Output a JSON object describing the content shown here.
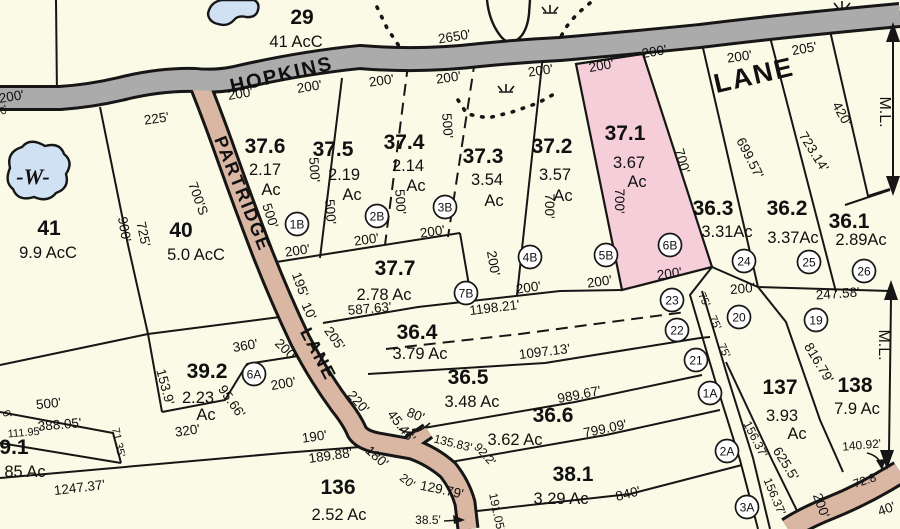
{
  "map": {
    "colors": {
      "parcel_fill": "#FAFAE6",
      "line": "#161616",
      "highlight_parcel": "#F6CEDA",
      "road_paved": "#ABABAB",
      "road_partridge": "#D9B7A3",
      "water": "#CFE1F2"
    },
    "roads": [
      {
        "name": "HOPKINS",
        "x": 283,
        "y": 81,
        "rot": -13,
        "fs": 20,
        "ls": 3
      },
      {
        "name": "LANE",
        "x": 756,
        "y": 84,
        "rot": -13,
        "fs": 27,
        "ls": 8
      },
      {
        "name": "PARTRIDGE",
        "x": 237,
        "y": 196,
        "rot": 68,
        "fs": 18,
        "ls": 2
      },
      {
        "name": "LANE",
        "x": 313,
        "y": 357,
        "rot": 62,
        "fs": 18,
        "ls": 2
      }
    ],
    "water_label": {
      "t": "-W-",
      "x": 33,
      "y": 184,
      "fs": 22
    },
    "match_line_labels": [
      {
        "t": "M.L.",
        "x": 880,
        "y": 112,
        "rot": 90,
        "fs": 16
      },
      {
        "t": "M.L.",
        "x": 879,
        "y": 345,
        "rot": 90,
        "fs": 16
      }
    ],
    "parcels": [
      {
        "id": "29",
        "number": "29",
        "nx": 302,
        "ny": 24,
        "acres": [
          {
            "t": "41  AcC",
            "x": 296,
            "y": 47
          }
        ],
        "highlighted": false
      },
      {
        "id": "41",
        "number": "41",
        "nx": 49,
        "ny": 235,
        "acres": [
          {
            "t": "9.9  AcC",
            "x": 48,
            "y": 258
          }
        ],
        "highlighted": false
      },
      {
        "id": "40",
        "number": "40",
        "nx": 181,
        "ny": 237,
        "acres": [
          {
            "t": "5.0  AcC",
            "x": 196,
            "y": 260
          }
        ],
        "highlighted": false
      },
      {
        "id": "37.6",
        "number": "37.6",
        "nx": 265,
        "ny": 153,
        "acres": [
          {
            "t": "2.17",
            "x": 265,
            "y": 175
          },
          {
            "t": "Ac",
            "x": 271,
            "y": 195
          }
        ],
        "highlighted": false
      },
      {
        "id": "37.5",
        "number": "37.5",
        "nx": 333,
        "ny": 156,
        "acres": [
          {
            "t": "2.19",
            "x": 344,
            "y": 180
          },
          {
            "t": "Ac",
            "x": 352,
            "y": 200
          }
        ],
        "highlighted": false
      },
      {
        "id": "37.4",
        "number": "37.4",
        "nx": 404,
        "ny": 149,
        "acres": [
          {
            "t": "2.14",
            "x": 408,
            "y": 171
          },
          {
            "t": "Ac",
            "x": 416,
            "y": 191
          }
        ],
        "highlighted": false
      },
      {
        "id": "37.3",
        "number": "37.3",
        "nx": 483,
        "ny": 163,
        "acres": [
          {
            "t": "3.54",
            "x": 487,
            "y": 185
          },
          {
            "t": "Ac",
            "x": 494,
            "y": 206
          }
        ],
        "highlighted": false
      },
      {
        "id": "37.2",
        "number": "37.2",
        "nx": 552,
        "ny": 153,
        "acres": [
          {
            "t": "3.57",
            "x": 555,
            "y": 180
          },
          {
            "t": "Ac",
            "x": 563,
            "y": 201
          }
        ],
        "highlighted": false
      },
      {
        "id": "37.1",
        "number": "37.1",
        "nx": 625,
        "ny": 140,
        "acres": [
          {
            "t": "3.67",
            "x": 629,
            "y": 168
          },
          {
            "t": "Ac",
            "x": 637,
            "y": 187
          }
        ],
        "highlighted": true
      },
      {
        "id": "37.7",
        "number": "37.7",
        "nx": 395,
        "ny": 275,
        "acres": [
          {
            "t": "2.78  Ac",
            "x": 384,
            "y": 300
          }
        ],
        "highlighted": false
      },
      {
        "id": "36.3",
        "number": "36.3",
        "nx": 713,
        "ny": 215,
        "acres": [
          {
            "t": "3.31Ac",
            "x": 727,
            "y": 237
          }
        ],
        "highlighted": false
      },
      {
        "id": "36.2",
        "number": "36.2",
        "nx": 787,
        "ny": 215,
        "acres": [
          {
            "t": "3.37Ac",
            "x": 793,
            "y": 243
          }
        ],
        "highlighted": false
      },
      {
        "id": "36.1",
        "number": "36.1",
        "nx": 849,
        "ny": 228,
        "acres": [
          {
            "t": "2.89Ac",
            "x": 861,
            "y": 245
          }
        ],
        "highlighted": false
      },
      {
        "id": "36.4",
        "number": "36.4",
        "nx": 417,
        "ny": 339,
        "acres": [
          {
            "t": "3.79  Ac",
            "x": 420,
            "y": 359
          }
        ],
        "highlighted": false
      },
      {
        "id": "36.5",
        "number": "36.5",
        "nx": 468,
        "ny": 384,
        "acres": [
          {
            "t": "3.48  Ac",
            "x": 472,
            "y": 407
          }
        ],
        "highlighted": false
      },
      {
        "id": "36.6",
        "number": "36.6",
        "nx": 553,
        "ny": 422,
        "acres": [
          {
            "t": "3.62  Ac",
            "x": 515,
            "y": 445
          }
        ],
        "highlighted": false
      },
      {
        "id": "38.1",
        "number": "38.1",
        "nx": 573,
        "ny": 481,
        "acres": [
          {
            "t": "3.29  Ac",
            "x": 561,
            "y": 504
          }
        ],
        "highlighted": false
      },
      {
        "id": "136",
        "number": "136",
        "nx": 338,
        "ny": 494,
        "acres": [
          {
            "t": "2.52  Ac",
            "x": 339,
            "y": 520
          }
        ],
        "highlighted": false
      },
      {
        "id": "137",
        "number": "137",
        "nx": 780,
        "ny": 394,
        "acres": [
          {
            "t": "3.93",
            "x": 782,
            "y": 421
          },
          {
            "t": "Ac",
            "x": 797,
            "y": 439
          }
        ],
        "highlighted": false
      },
      {
        "id": "138",
        "number": "138",
        "nx": 855,
        "ny": 392,
        "acres": [
          {
            "t": "7.9  Ac",
            "x": 857,
            "y": 414
          }
        ],
        "highlighted": false
      },
      {
        "id": "39.2",
        "number": "39.2",
        "nx": 207,
        "ny": 378,
        "acres": [
          {
            "t": "2.23",
            "x": 198,
            "y": 403
          },
          {
            "t": "Ac",
            "x": 206,
            "y": 420
          }
        ],
        "highlighted": false
      },
      {
        "id": "39.1",
        "number": "9.1",
        "nx": 14,
        "ny": 454,
        "acres": [
          {
            "t": "85  Ac",
            "x": 25,
            "y": 477
          }
        ],
        "highlighted": false
      }
    ],
    "badges": [
      {
        "t": "1B",
        "x": 297,
        "y": 224
      },
      {
        "t": "2B",
        "x": 377,
        "y": 216
      },
      {
        "t": "3B",
        "x": 445,
        "y": 207
      },
      {
        "t": "4B",
        "x": 530,
        "y": 257
      },
      {
        "t": "5B",
        "x": 606,
        "y": 255
      },
      {
        "t": "6B",
        "x": 670,
        "y": 245
      },
      {
        "t": "7B",
        "x": 466,
        "y": 293
      },
      {
        "t": "6A",
        "x": 254,
        "y": 374
      },
      {
        "t": "1A",
        "x": 710,
        "y": 393
      },
      {
        "t": "2A",
        "x": 727,
        "y": 451
      },
      {
        "t": "3A",
        "x": 747,
        "y": 507
      },
      {
        "t": "19",
        "x": 816,
        "y": 320
      },
      {
        "t": "20",
        "x": 739,
        "y": 317
      },
      {
        "t": "21",
        "x": 696,
        "y": 360
      },
      {
        "t": "22",
        "x": 677,
        "y": 330
      },
      {
        "t": "23",
        "x": 672,
        "y": 300
      },
      {
        "t": "24",
        "x": 744,
        "y": 261
      },
      {
        "t": "25",
        "x": 809,
        "y": 262
      },
      {
        "t": "26",
        "x": 864,
        "y": 271
      }
    ],
    "dimensions": [
      {
        "t": "2650'",
        "x": 455,
        "y": 41,
        "r": -9
      },
      {
        "t": "200'",
        "x": 12,
        "y": 101,
        "r": -9
      },
      {
        "t": "200'",
        "x": 241,
        "y": 98,
        "r": -9
      },
      {
        "t": "200'",
        "x": 310,
        "y": 91,
        "r": -9
      },
      {
        "t": "200'",
        "x": 382,
        "y": 85,
        "r": -8
      },
      {
        "t": "200'",
        "x": 449,
        "y": 82,
        "r": -8
      },
      {
        "t": "200'",
        "x": 541,
        "y": 75,
        "r": -8
      },
      {
        "t": "200'",
        "x": 602,
        "y": 70,
        "r": -10
      },
      {
        "t": "200'",
        "x": 655,
        "y": 56,
        "r": -10
      },
      {
        "t": "200'",
        "x": 740,
        "y": 61,
        "r": -8
      },
      {
        "t": "205'",
        "x": 805,
        "y": 53,
        "r": -10
      },
      {
        "t": "225'",
        "x": 157,
        "y": 123,
        "r": -8
      },
      {
        "t": "500'",
        "x": 266,
        "y": 217,
        "r": 72
      },
      {
        "t": "500'",
        "x": 310,
        "y": 170,
        "r": 86
      },
      {
        "t": "500'",
        "x": 326,
        "y": 212,
        "r": 86
      },
      {
        "t": "500'",
        "x": 396,
        "y": 202,
        "r": 86
      },
      {
        "t": "500'",
        "x": 443,
        "y": 126,
        "r": 86
      },
      {
        "t": "700'",
        "x": 545,
        "y": 206,
        "r": 90
      },
      {
        "t": "700'",
        "x": 615,
        "y": 201,
        "r": 90
      },
      {
        "t": "700'",
        "x": 678,
        "y": 162,
        "r": 74
      },
      {
        "t": "699.57'",
        "x": 746,
        "y": 160,
        "r": 63
      },
      {
        "t": "723.14'",
        "x": 810,
        "y": 154,
        "r": 58
      },
      {
        "t": "420'",
        "x": 838,
        "y": 116,
        "r": 61
      },
      {
        "t": "900'",
        "x": 120,
        "y": 230,
        "r": 80
      },
      {
        "t": "725'",
        "x": 139,
        "y": 235,
        "r": 78
      },
      {
        "t": "700'S",
        "x": 194,
        "y": 200,
        "r": 70
      },
      {
        "t": "195'",
        "x": 296,
        "y": 286,
        "r": 70
      },
      {
        "t": "10'",
        "x": 305,
        "y": 313,
        "r": 65
      },
      {
        "t": "205'",
        "x": 331,
        "y": 341,
        "r": 55
      },
      {
        "t": "200'",
        "x": 283,
        "y": 353,
        "r": 45
      },
      {
        "t": "200'",
        "x": 284,
        "y": 388,
        "r": -10
      },
      {
        "t": "360'",
        "x": 246,
        "y": 350,
        "r": -10
      },
      {
        "t": "153.9'",
        "x": 161,
        "y": 388,
        "r": 75
      },
      {
        "t": "95.66'",
        "x": 228,
        "y": 404,
        "r": 55
      },
      {
        "t": "320'",
        "x": 188,
        "y": 435,
        "r": -8
      },
      {
        "t": "111.95'",
        "x": 25,
        "y": 436,
        "r": -5,
        "fs": 11
      },
      {
        "t": "71.35'",
        "x": 115,
        "y": 443,
        "r": 78,
        "fs": 11
      },
      {
        "t": "500'",
        "x": 49,
        "y": 408,
        "r": -6
      },
      {
        "t": "388.05'",
        "x": 60,
        "y": 429,
        "r": -5
      },
      {
        "t": "1247.37'",
        "x": 80,
        "y": 492,
        "r": -7
      },
      {
        "t": "190'",
        "x": 315,
        "y": 441,
        "r": -8
      },
      {
        "t": "189.88'",
        "x": 331,
        "y": 460,
        "r": -8
      },
      {
        "t": "180'",
        "x": 374,
        "y": 460,
        "r": 42
      },
      {
        "t": "220'",
        "x": 355,
        "y": 405,
        "r": 48
      },
      {
        "t": "45.46'",
        "x": 398,
        "y": 429,
        "r": 52
      },
      {
        "t": "80'",
        "x": 414,
        "y": 419,
        "r": 22
      },
      {
        "t": "20'",
        "x": 405,
        "y": 484,
        "r": 38,
        "fs": 12
      },
      {
        "t": "129.79'",
        "x": 441,
        "y": 494,
        "r": 12
      },
      {
        "t": "38.5'",
        "x": 428,
        "y": 524,
        "r": 0,
        "fs": 12
      },
      {
        "t": "135.83'",
        "x": 452,
        "y": 447,
        "r": 14,
        "fs": 12
      },
      {
        "t": "92.2'",
        "x": 482,
        "y": 457,
        "r": 48,
        "fs": 12
      },
      {
        "t": "191.05'",
        "x": 493,
        "y": 513,
        "r": 78,
        "fs": 12
      },
      {
        "t": "587.63'",
        "x": 370,
        "y": 313,
        "r": -5
      },
      {
        "t": "1198.21'",
        "x": 495,
        "y": 312,
        "r": -7
      },
      {
        "t": "200'",
        "x": 298,
        "y": 255,
        "r": -8
      },
      {
        "t": "200'",
        "x": 367,
        "y": 244,
        "r": -8
      },
      {
        "t": "200'",
        "x": 433,
        "y": 236,
        "r": -8
      },
      {
        "t": "200'",
        "x": 489,
        "y": 264,
        "r": 80
      },
      {
        "t": "200'",
        "x": 529,
        "y": 292,
        "r": -8
      },
      {
        "t": "200'",
        "x": 600,
        "y": 286,
        "r": -8
      },
      {
        "t": "200'",
        "x": 670,
        "y": 278,
        "r": -8
      },
      {
        "t": "200'",
        "x": 743,
        "y": 293,
        "r": -5
      },
      {
        "t": "247.58'",
        "x": 838,
        "y": 298,
        "r": -4
      },
      {
        "t": "75'",
        "x": 701,
        "y": 301,
        "r": 65,
        "fs": 11
      },
      {
        "t": "75'",
        "x": 712,
        "y": 324,
        "r": 65,
        "fs": 11
      },
      {
        "t": "75'",
        "x": 721,
        "y": 352,
        "r": 65,
        "fs": 11
      },
      {
        "t": "1097.13'",
        "x": 545,
        "y": 356,
        "r": -7
      },
      {
        "t": "989.67'",
        "x": 580,
        "y": 399,
        "r": -11
      },
      {
        "t": "799.09'",
        "x": 606,
        "y": 433,
        "r": -12
      },
      {
        "t": "840'",
        "x": 629,
        "y": 498,
        "r": -14
      },
      {
        "t": "156.37'",
        "x": 752,
        "y": 441,
        "r": 63,
        "fs": 12
      },
      {
        "t": "156.37'",
        "x": 771,
        "y": 498,
        "r": 67,
        "fs": 12
      },
      {
        "t": "625.5'",
        "x": 782,
        "y": 466,
        "r": 58
      },
      {
        "t": "816.79'",
        "x": 815,
        "y": 365,
        "r": 59
      },
      {
        "t": "140.92'",
        "x": 862,
        "y": 449,
        "r": -5,
        "fs": 12
      },
      {
        "t": "72.8'",
        "x": 867,
        "y": 484,
        "r": -18,
        "fs": 12
      },
      {
        "t": "200'",
        "x": 817,
        "y": 507,
        "r": 70
      },
      {
        "t": "40'",
        "x": 888,
        "y": 513,
        "r": -20
      },
      {
        "t": "0'",
        "x": 6,
        "y": 113,
        "r": -35,
        "fs": 11
      },
      {
        "t": "0'",
        "x": 4,
        "y": 416,
        "r": 60,
        "fs": 11
      }
    ]
  }
}
